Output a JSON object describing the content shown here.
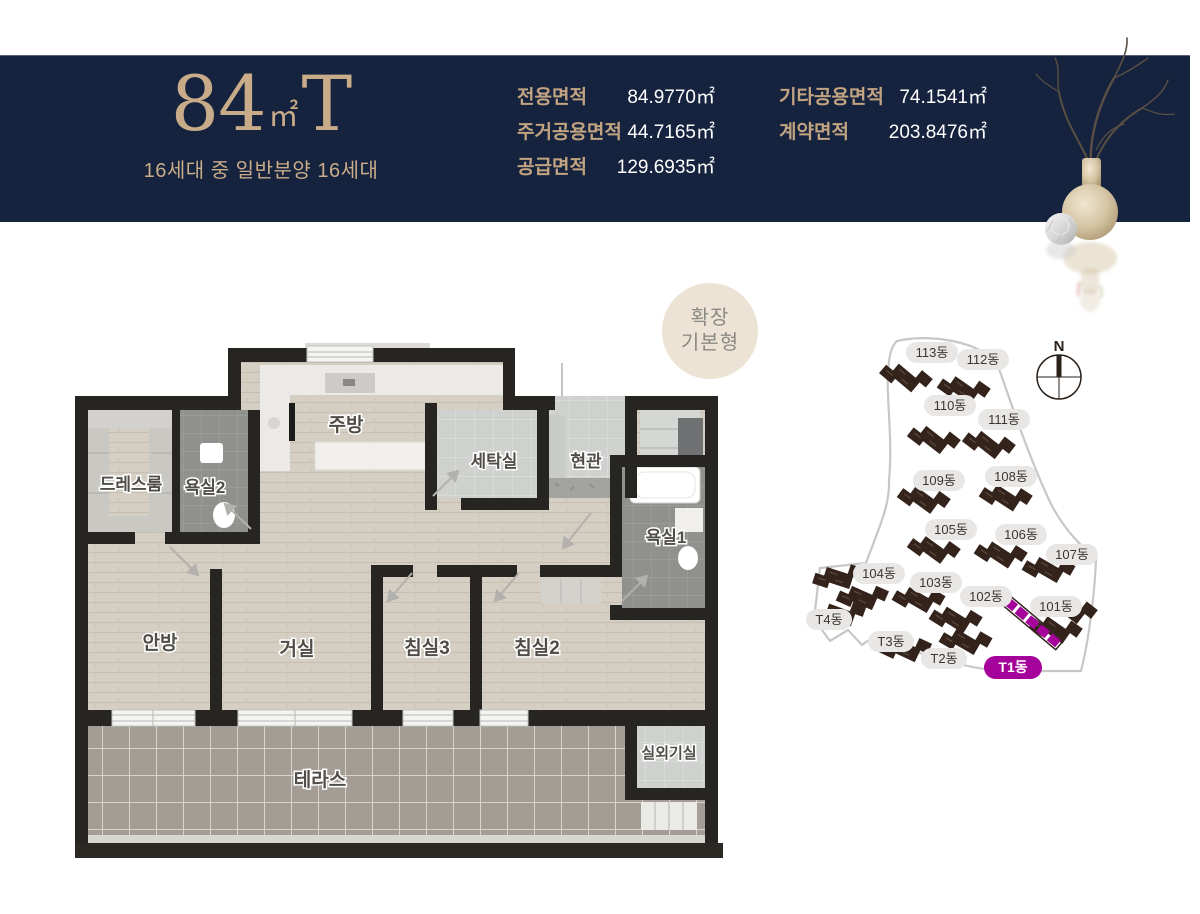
{
  "header": {
    "title_number": "84",
    "title_unit": "㎡",
    "title_type": "T",
    "subtitle": "16세대 중 일반분양 16세대",
    "area_table": {
      "col1": [
        {
          "label": "전용면적",
          "value": "84.9770㎡"
        },
        {
          "label": "주거공용면적",
          "value": "44.7165㎡"
        },
        {
          "label": "공급면적",
          "value": "129.6935㎡"
        }
      ],
      "col2": [
        {
          "label": "기타공용면적",
          "value": "74.1541㎡"
        },
        {
          "label": "계약면적",
          "value": "203.8476㎡"
        }
      ]
    }
  },
  "badge": {
    "line1": "확장",
    "line2": "기본형"
  },
  "floor_plan": {
    "rooms": {
      "kitchen": "주방",
      "dress_room": "드레스룸",
      "bath2": "욕실2",
      "laundry": "세탁실",
      "entrance": "현관",
      "bath1": "욕실1",
      "master_bedroom": "안방",
      "living_room": "거실",
      "bedroom3": "침실3",
      "bedroom2": "침실2",
      "outdoor_unit_room": "실외기실",
      "terrace": "테라스"
    }
  },
  "site_plan": {
    "compass_label": "N",
    "buildings": [
      "113동",
      "112동",
      "110동",
      "111동",
      "109동",
      "108동",
      "105동",
      "106동",
      "107동",
      "104동",
      "103동",
      "102동",
      "101동",
      "T4동",
      "T3동",
      "T2동"
    ],
    "highlighted_building": "T1동"
  },
  "colors": {
    "band_navy": "#16233e",
    "title_gold": "#c8ab88",
    "badge_bg": "#ece3d4",
    "highlight_magenta": "#a5019b",
    "wall_dark": "#272521",
    "wood_floor": "#d5cfc3",
    "terrace_gray": "#a39d95"
  }
}
